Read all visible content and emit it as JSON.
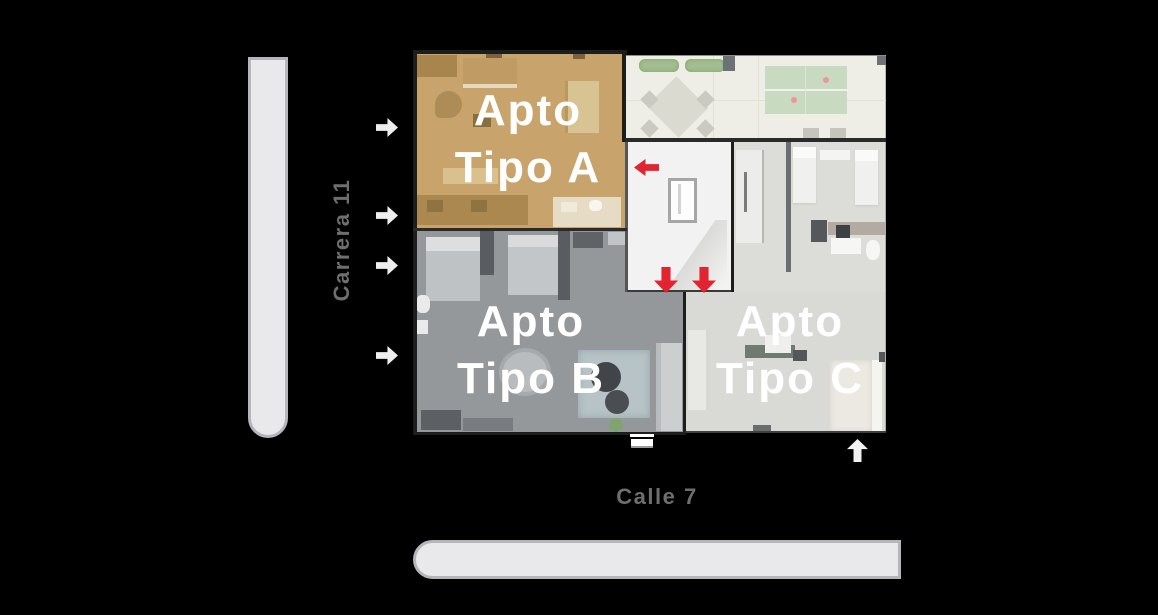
{
  "scene": {
    "background": "#000000",
    "description_labels": {
      "street_vertical": "Carrera 11",
      "street_horizontal": "Calle 7"
    }
  },
  "streets": {
    "carrera": {
      "label": "Carrera 11",
      "text_color": "#6e6e6e",
      "bar_fill": "#e9e9eb",
      "bar_border": "#b5b5bb"
    },
    "calle": {
      "label": "Calle 7",
      "text_color": "#6e6e6e",
      "bar_fill": "#e9e9eb",
      "bar_border": "#b5b5bb"
    }
  },
  "floorplan": {
    "apartments": [
      {
        "id": "apto-a",
        "line1": "Apto",
        "line2": "Tipo A",
        "base_color": "#c8a46c",
        "text_color": "#ffffff"
      },
      {
        "id": "apto-b",
        "line1": "Apto",
        "line2": "Tipo B",
        "base_color": "#95989b",
        "text_color": "#ffffff"
      },
      {
        "id": "apto-c",
        "line1": "Apto",
        "line2": "Tipo C",
        "base_color": "#dcdcd9",
        "text_color": "#ffffff"
      }
    ],
    "terrace": {
      "base_color": "#efeee6",
      "pingpong_color": "#c8dabf"
    },
    "core": {
      "base_color": "#f2f2f2",
      "arrow_color": "#e1242f"
    }
  },
  "icons": {
    "street_direction_arrows": {
      "name": "street-direction-arrow-icon",
      "count": 4,
      "direction": "right",
      "color": "#eeeeee"
    },
    "building_entrance_arrow": {
      "name": "building-entrance-arrow-icon",
      "direction": "up",
      "color": "#f2f2f2"
    },
    "core_exit_left_arrow": {
      "name": "core-exit-left-arrow-icon",
      "direction": "left",
      "color": "#e1242f"
    },
    "core_exit_down_arrows": {
      "name": "core-exit-down-arrow-icon",
      "count": 2,
      "direction": "down",
      "color": "#e1242f"
    }
  }
}
